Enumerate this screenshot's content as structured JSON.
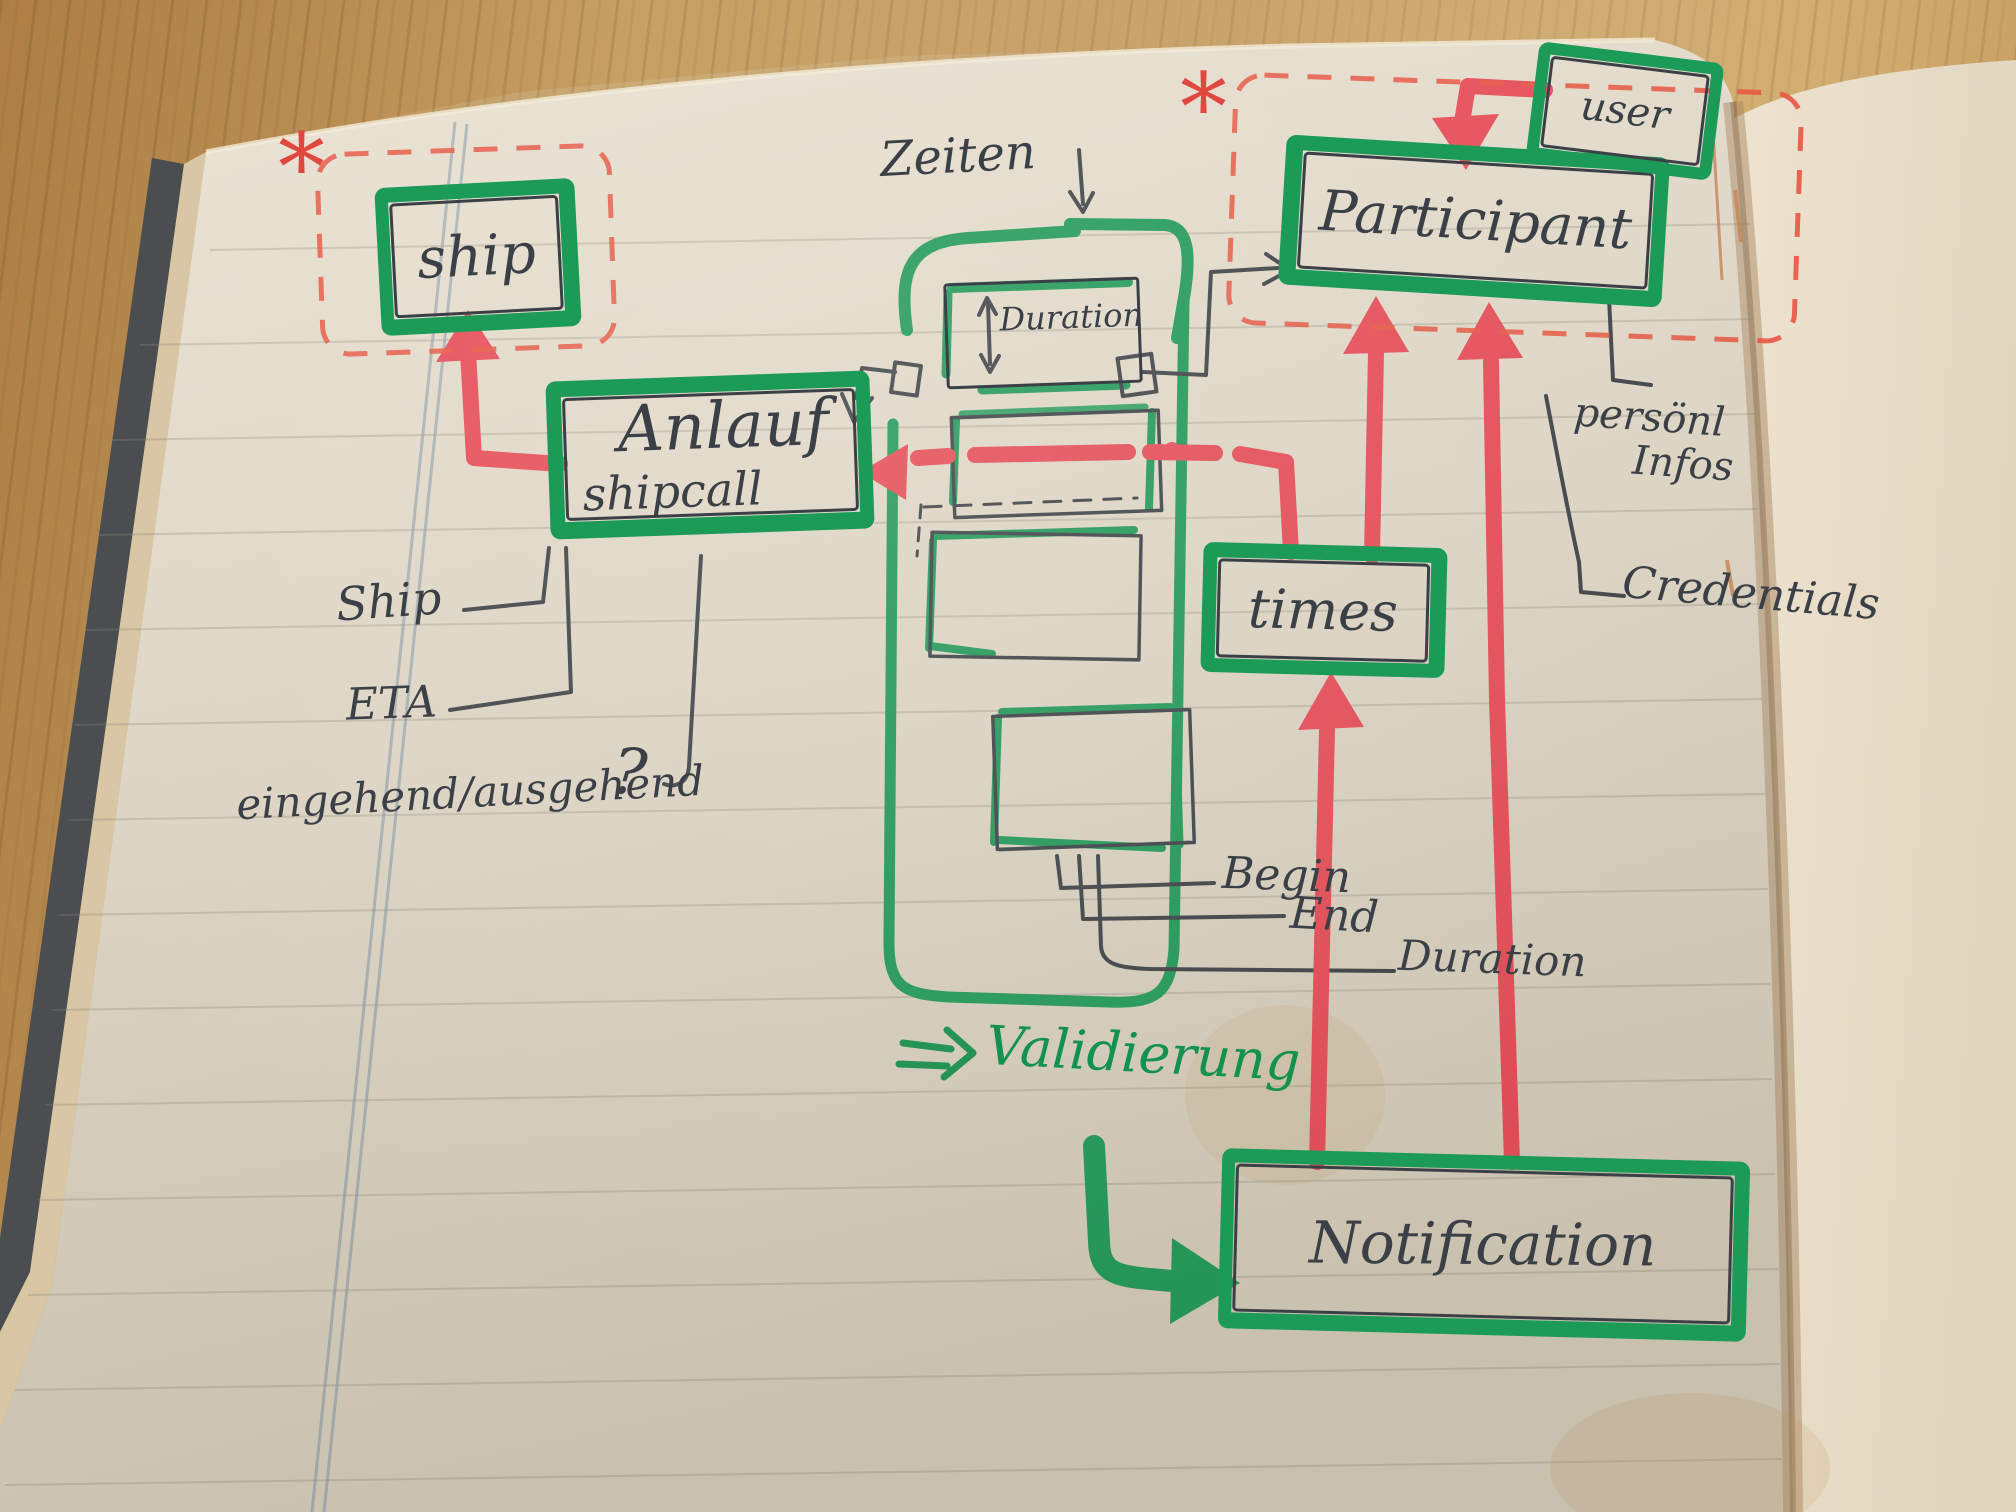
{
  "nodes": {
    "ship": {
      "label": "ship"
    },
    "shipcall": {
      "label": "Anlauf",
      "sublabel": "shipcall"
    },
    "participant": {
      "label": "Participant"
    },
    "user": {
      "label": "user"
    },
    "times": {
      "label": "times"
    },
    "notification": {
      "label": "Notification"
    },
    "duration": {
      "label": "Duration"
    }
  },
  "annotations": {
    "zeiten": "Zeiten",
    "ship_attr": "Ship",
    "eta_attr": "ETA",
    "inout_attr": "eingehend/ausgehend",
    "question_mark": "?",
    "begin_attr": "Begin",
    "end_attr": "End",
    "duration_attr": "Duration",
    "personal_line1": "persönl",
    "personal_line2": "Infos",
    "credentials_attr": "Credentials",
    "validierung": "Validierung",
    "asterisk": "*"
  },
  "colors": {
    "marker_green": "#1c9a58",
    "marker_red": "#e94a57",
    "dashed_red": "#e85742",
    "pen": "#3b4046",
    "paper": "#e6decf"
  }
}
